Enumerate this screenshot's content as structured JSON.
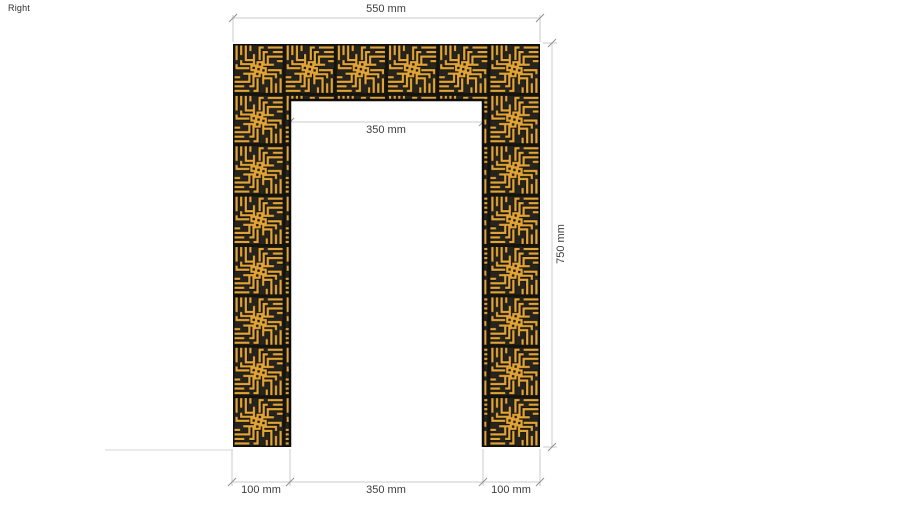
{
  "viewport": {
    "view_label": "Right",
    "background_color": "#ffffff"
  },
  "model": {
    "description": "door-portal-frame-with-square-kufic-panels",
    "panel_gold_color": "#e2a437",
    "panel_background_color": "#26241d",
    "panel_outline_color": "#0d0d0d",
    "tile_rows_per_column": 8,
    "tiles_across_top": 6
  },
  "dimensions": {
    "top_width": "550 mm",
    "opening_width": "350 mm",
    "total_height": "750 mm",
    "bottom_left_column": "100 mm",
    "bottom_opening": "350 mm",
    "bottom_right_column": "100 mm"
  }
}
